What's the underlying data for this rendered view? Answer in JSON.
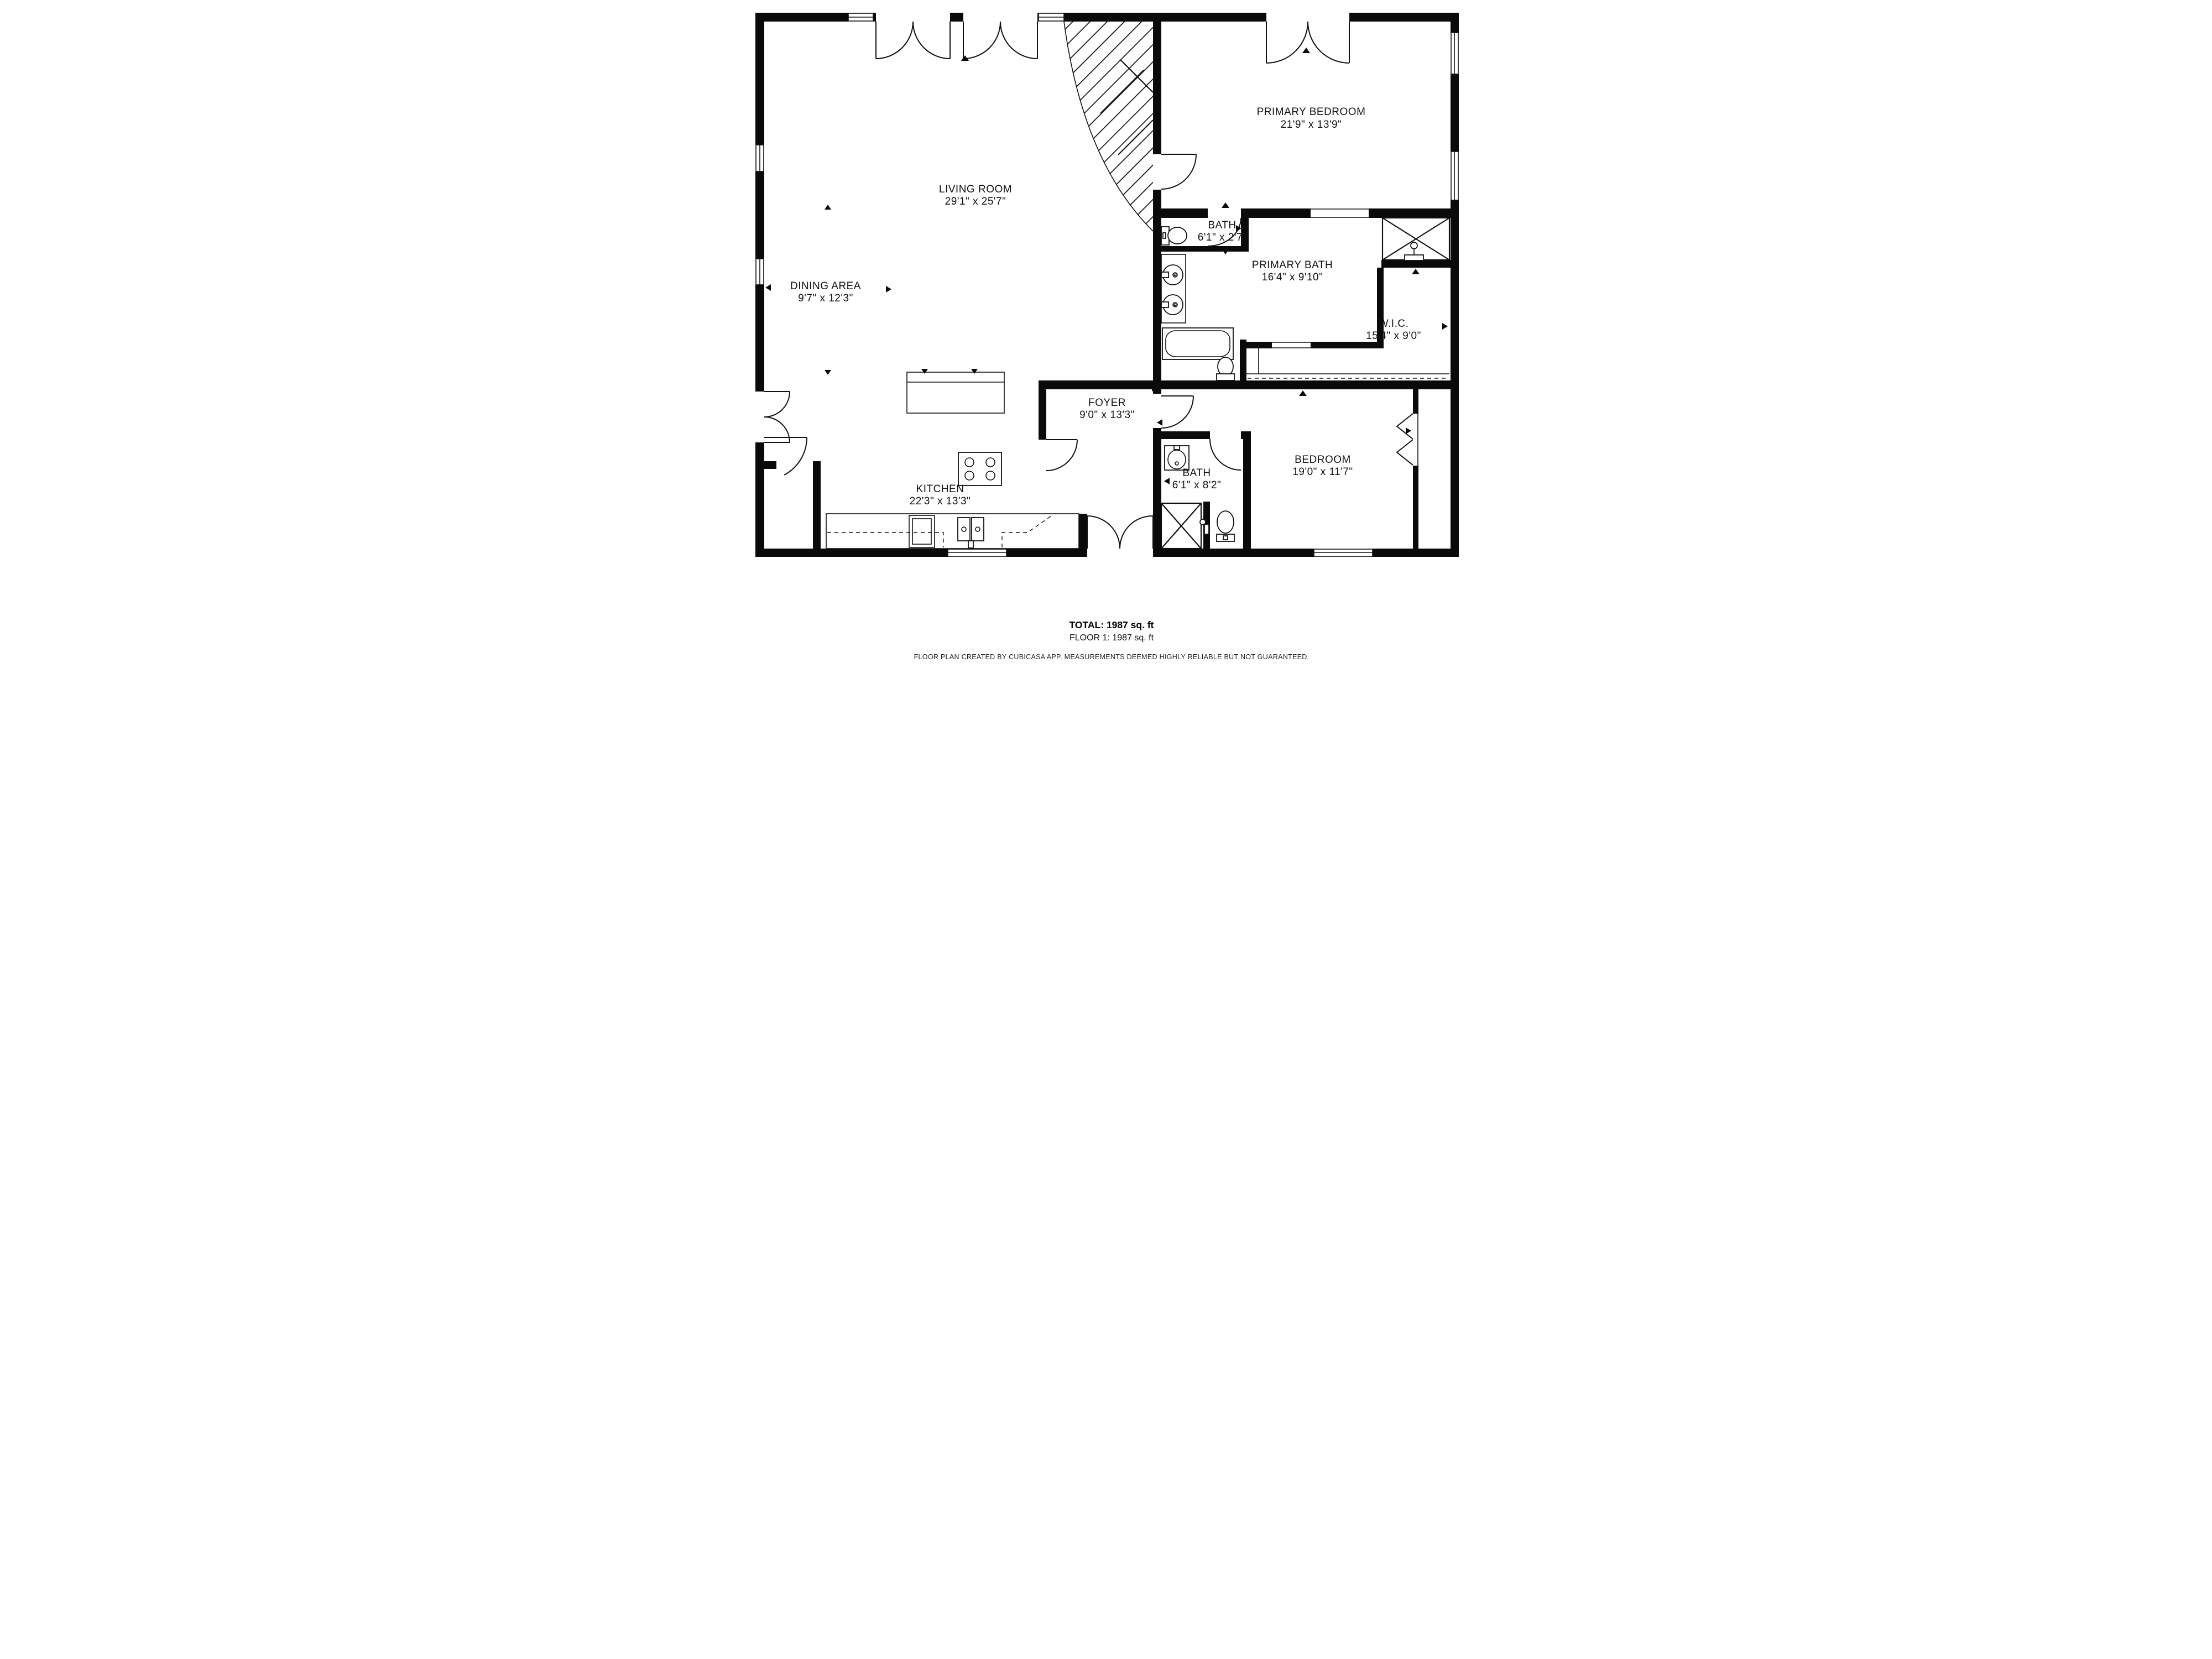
{
  "plan": {
    "rooms": {
      "living": {
        "name": "LIVING ROOM",
        "dims": "29'1\" x 25'7\""
      },
      "primary_bedroom": {
        "name": "PRIMARY BEDROOM",
        "dims": "21'9\" x 13'9\""
      },
      "wc_bath": {
        "name": "BATH",
        "dims": "6'1\" x 2'7\""
      },
      "primary_bath": {
        "name": "PRIMARY BATH",
        "dims": "16'4\" x 9'10\""
      },
      "wic": {
        "name": "W.I.C.",
        "dims": "15'4\" x 9'0\""
      },
      "dining": {
        "name": "DINING AREA",
        "dims": "9'7\" x 12'3\""
      },
      "foyer": {
        "name": "FOYER",
        "dims": "9'0\" x 13'3\""
      },
      "kitchen": {
        "name": "KITCHEN",
        "dims": "22'3\" x 13'3\""
      },
      "bath2": {
        "name": "BATH",
        "dims": "6'1\" x 8'2\""
      },
      "bedroom": {
        "name": "BEDROOM",
        "dims": "19'0\" x 11'7\""
      }
    },
    "summary": {
      "total": "TOTAL: 1987 sq. ft",
      "floor": "FLOOR 1: 1987 sq. ft"
    },
    "disclaimer": "FLOOR PLAN CREATED BY CUBICASA APP. MEASUREMENTS DEEMED HIGHLY RELIABLE BUT NOT GUARANTEED.",
    "colors": {
      "wall": "#0a0a0a",
      "background": "#ffffff"
    }
  }
}
